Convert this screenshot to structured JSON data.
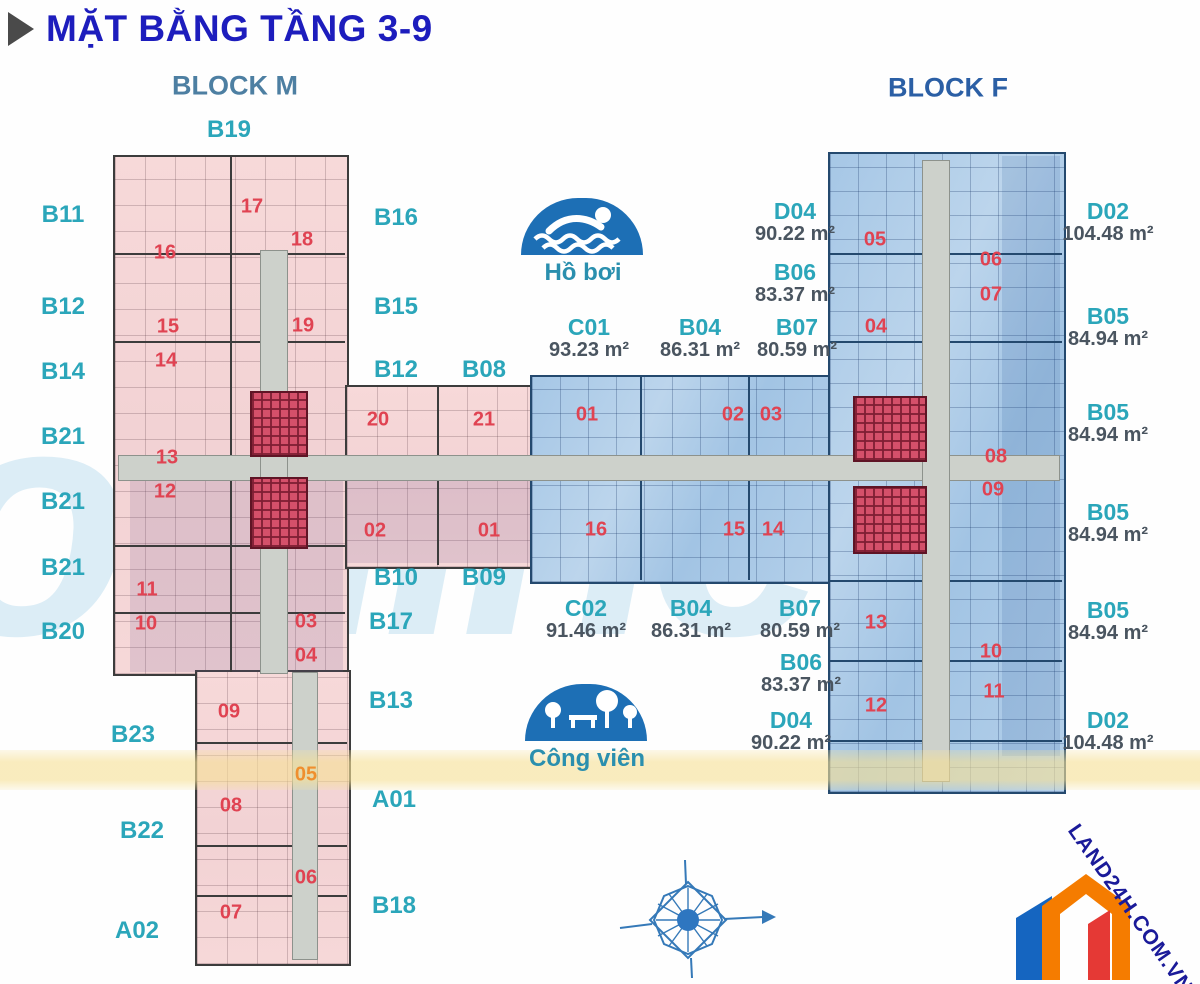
{
  "title": {
    "text": "MẶT BẰNG TẦNG 3-9",
    "icon": "play-triangle-icon"
  },
  "block_headers": [
    {
      "id": "m",
      "label": "BLOCK M",
      "x": 235,
      "y": 86
    },
    {
      "id": "f",
      "label": "BLOCK F",
      "x": 948,
      "y": 88
    }
  ],
  "amenities": [
    {
      "name": "pool",
      "label": "Hồ bơi"
    },
    {
      "name": "park",
      "label": "Công viên"
    }
  ],
  "watermark_text": "online",
  "logo_text": "LAND24H.COM.VN",
  "colors": {
    "title": "#1d1dbd",
    "block_m_header": "#4d7fa2",
    "block_f_header": "#2b5fa5",
    "type_label": "#2ba6ba",
    "area_text": "#4a5560",
    "unit_number": "#e04352",
    "unit_number_alt": "#ef8f2e",
    "amenity": "#2a8fae",
    "dome": "#1d6fb5",
    "logo_text": "#1a1a99"
  },
  "type_labels": [
    {
      "text": "B19",
      "x": 229,
      "y": 130
    },
    {
      "text": "B11",
      "x": 63,
      "y": 215
    },
    {
      "text": "B12",
      "x": 63,
      "y": 307
    },
    {
      "text": "B14",
      "x": 63,
      "y": 372
    },
    {
      "text": "B21",
      "x": 63,
      "y": 437
    },
    {
      "text": "B21",
      "x": 63,
      "y": 502
    },
    {
      "text": "B21",
      "x": 63,
      "y": 568
    },
    {
      "text": "B20",
      "x": 63,
      "y": 632
    },
    {
      "text": "B23",
      "x": 133,
      "y": 735
    },
    {
      "text": "B22",
      "x": 142,
      "y": 831
    },
    {
      "text": "A02",
      "x": 137,
      "y": 931
    },
    {
      "text": "B16",
      "x": 396,
      "y": 218
    },
    {
      "text": "B15",
      "x": 396,
      "y": 307
    },
    {
      "text": "B12",
      "x": 396,
      "y": 370
    },
    {
      "text": "B08",
      "x": 484,
      "y": 370
    },
    {
      "text": "B10",
      "x": 396,
      "y": 578
    },
    {
      "text": "B09",
      "x": 484,
      "y": 578
    },
    {
      "text": "B17",
      "x": 391,
      "y": 622
    },
    {
      "text": "B13",
      "x": 391,
      "y": 701
    },
    {
      "text": "A01",
      "x": 394,
      "y": 800
    },
    {
      "text": "B18",
      "x": 394,
      "y": 906
    }
  ],
  "area_labels": [
    {
      "code": "C01",
      "area": "93.23 m²",
      "x": 589,
      "y": 338
    },
    {
      "code": "B04",
      "area": "86.31 m²",
      "x": 700,
      "y": 338
    },
    {
      "code": "B07",
      "area": "80.59 m²",
      "x": 797,
      "y": 338
    },
    {
      "code": "D04",
      "area": "90.22 m²",
      "x": 795,
      "y": 222
    },
    {
      "code": "B06",
      "area": "83.37 m²",
      "x": 795,
      "y": 283
    },
    {
      "code": "C02",
      "area": "91.46 m²",
      "x": 586,
      "y": 619
    },
    {
      "code": "B04",
      "area": "86.31 m²",
      "x": 691,
      "y": 619
    },
    {
      "code": "B07",
      "area": "80.59 m²",
      "x": 800,
      "y": 619
    },
    {
      "code": "B06",
      "area": "83.37 m²",
      "x": 801,
      "y": 673
    },
    {
      "code": "D04",
      "area": "90.22 m²",
      "x": 791,
      "y": 731
    },
    {
      "code": "D02",
      "area": "104.48 m²",
      "x": 1108,
      "y": 222
    },
    {
      "code": "B05",
      "area": "84.94 m²",
      "x": 1108,
      "y": 327
    },
    {
      "code": "B05",
      "area": "84.94 m²",
      "x": 1108,
      "y": 423
    },
    {
      "code": "B05",
      "area": "84.94 m²",
      "x": 1108,
      "y": 523
    },
    {
      "code": "B05",
      "area": "84.94 m²",
      "x": 1108,
      "y": 621
    },
    {
      "code": "D02",
      "area": "104.48 m²",
      "x": 1108,
      "y": 731
    }
  ],
  "unit_numbers": [
    {
      "n": "17",
      "x": 252,
      "y": 207
    },
    {
      "n": "18",
      "x": 302,
      "y": 240
    },
    {
      "n": "16",
      "x": 165,
      "y": 253
    },
    {
      "n": "15",
      "x": 168,
      "y": 327
    },
    {
      "n": "14",
      "x": 166,
      "y": 361
    },
    {
      "n": "19",
      "x": 303,
      "y": 326
    },
    {
      "n": "13",
      "x": 167,
      "y": 458
    },
    {
      "n": "12",
      "x": 165,
      "y": 492
    },
    {
      "n": "11",
      "x": 147,
      "y": 590
    },
    {
      "n": "10",
      "x": 146,
      "y": 624
    },
    {
      "n": "20",
      "x": 378,
      "y": 420
    },
    {
      "n": "21",
      "x": 484,
      "y": 420
    },
    {
      "n": "02",
      "x": 375,
      "y": 531
    },
    {
      "n": "01",
      "x": 489,
      "y": 531
    },
    {
      "n": "03",
      "x": 306,
      "y": 622
    },
    {
      "n": "04",
      "x": 306,
      "y": 656
    },
    {
      "n": "09",
      "x": 229,
      "y": 712
    },
    {
      "n": "05",
      "x": 306,
      "y": 775,
      "c": "alt"
    },
    {
      "n": "08",
      "x": 231,
      "y": 806
    },
    {
      "n": "06",
      "x": 306,
      "y": 878
    },
    {
      "n": "07",
      "x": 231,
      "y": 913
    },
    {
      "n": "01",
      "x": 587,
      "y": 415
    },
    {
      "n": "02",
      "x": 733,
      "y": 415
    },
    {
      "n": "03",
      "x": 771,
      "y": 415
    },
    {
      "n": "16",
      "x": 596,
      "y": 530
    },
    {
      "n": "15",
      "x": 734,
      "y": 530
    },
    {
      "n": "14",
      "x": 773,
      "y": 530
    },
    {
      "n": "05",
      "x": 875,
      "y": 240
    },
    {
      "n": "06",
      "x": 991,
      "y": 260
    },
    {
      "n": "07",
      "x": 991,
      "y": 295
    },
    {
      "n": "04",
      "x": 876,
      "y": 327
    },
    {
      "n": "08",
      "x": 996,
      "y": 457
    },
    {
      "n": "09",
      "x": 993,
      "y": 490
    },
    {
      "n": "13",
      "x": 876,
      "y": 623
    },
    {
      "n": "10",
      "x": 991,
      "y": 652
    },
    {
      "n": "11",
      "x": 994,
      "y": 692
    },
    {
      "n": "12",
      "x": 876,
      "y": 706
    }
  ]
}
